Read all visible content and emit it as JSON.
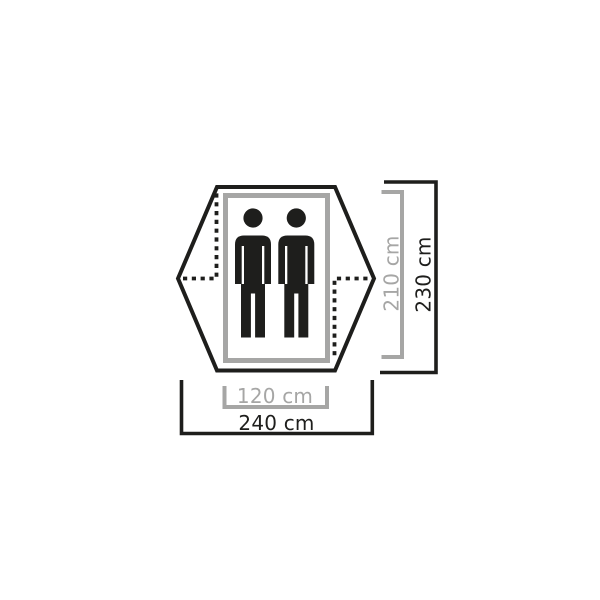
{
  "diagram": {
    "occupancy": {
      "person_icon": "person-icon",
      "person_icon_count": 2
    },
    "dimensions": {
      "inner_width": {
        "label": "120 cm",
        "value": 120,
        "unit": "cm"
      },
      "outer_width": {
        "label": "240 cm",
        "value": 240,
        "unit": "cm"
      },
      "inner_length": {
        "label": "210 cm",
        "value": 210,
        "unit": "cm"
      },
      "outer_length": {
        "label": "230 cm",
        "value": 230,
        "unit": "cm"
      }
    }
  },
  "colors": {
    "dark": "#1e1e1c",
    "gray": "#a6a6a5",
    "background": "#ffffff"
  }
}
